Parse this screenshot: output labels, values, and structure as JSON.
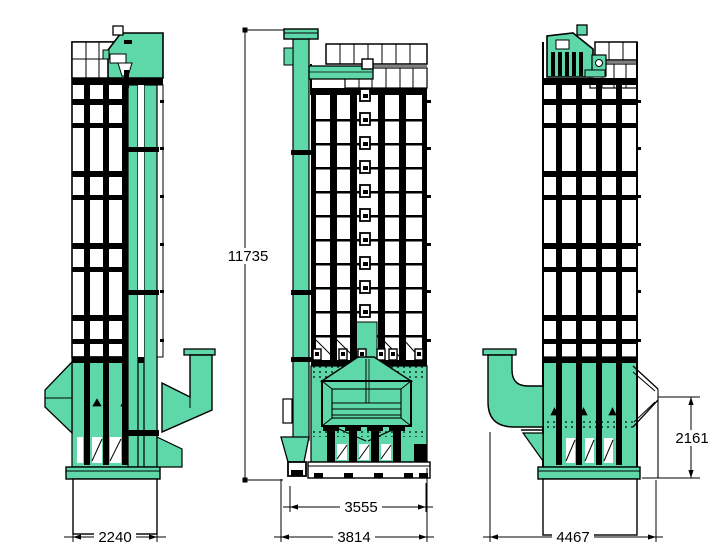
{
  "drawing": {
    "type": "CAD three-view elevation drawing",
    "subject": "tower grain dryer",
    "background_color": "#ffffff",
    "colors": {
      "machine_fill": "#5ed8a8",
      "line": "#000000"
    },
    "views": [
      {
        "name": "left side elevation"
      },
      {
        "name": "front elevation"
      },
      {
        "name": "right side elevation"
      }
    ],
    "dimensions": {
      "overall_height": {
        "value": "11735",
        "orientation": "vertical"
      },
      "left_view_width": {
        "value": "2240",
        "orientation": "horizontal"
      },
      "front_inner_width": {
        "value": "3555",
        "orientation": "horizontal"
      },
      "front_overall_width": {
        "value": "3814",
        "orientation": "horizontal"
      },
      "right_overall_width": {
        "value": "4467",
        "orientation": "horizontal"
      },
      "hopper_section_height": {
        "value": "2161",
        "orientation": "vertical"
      }
    }
  }
}
